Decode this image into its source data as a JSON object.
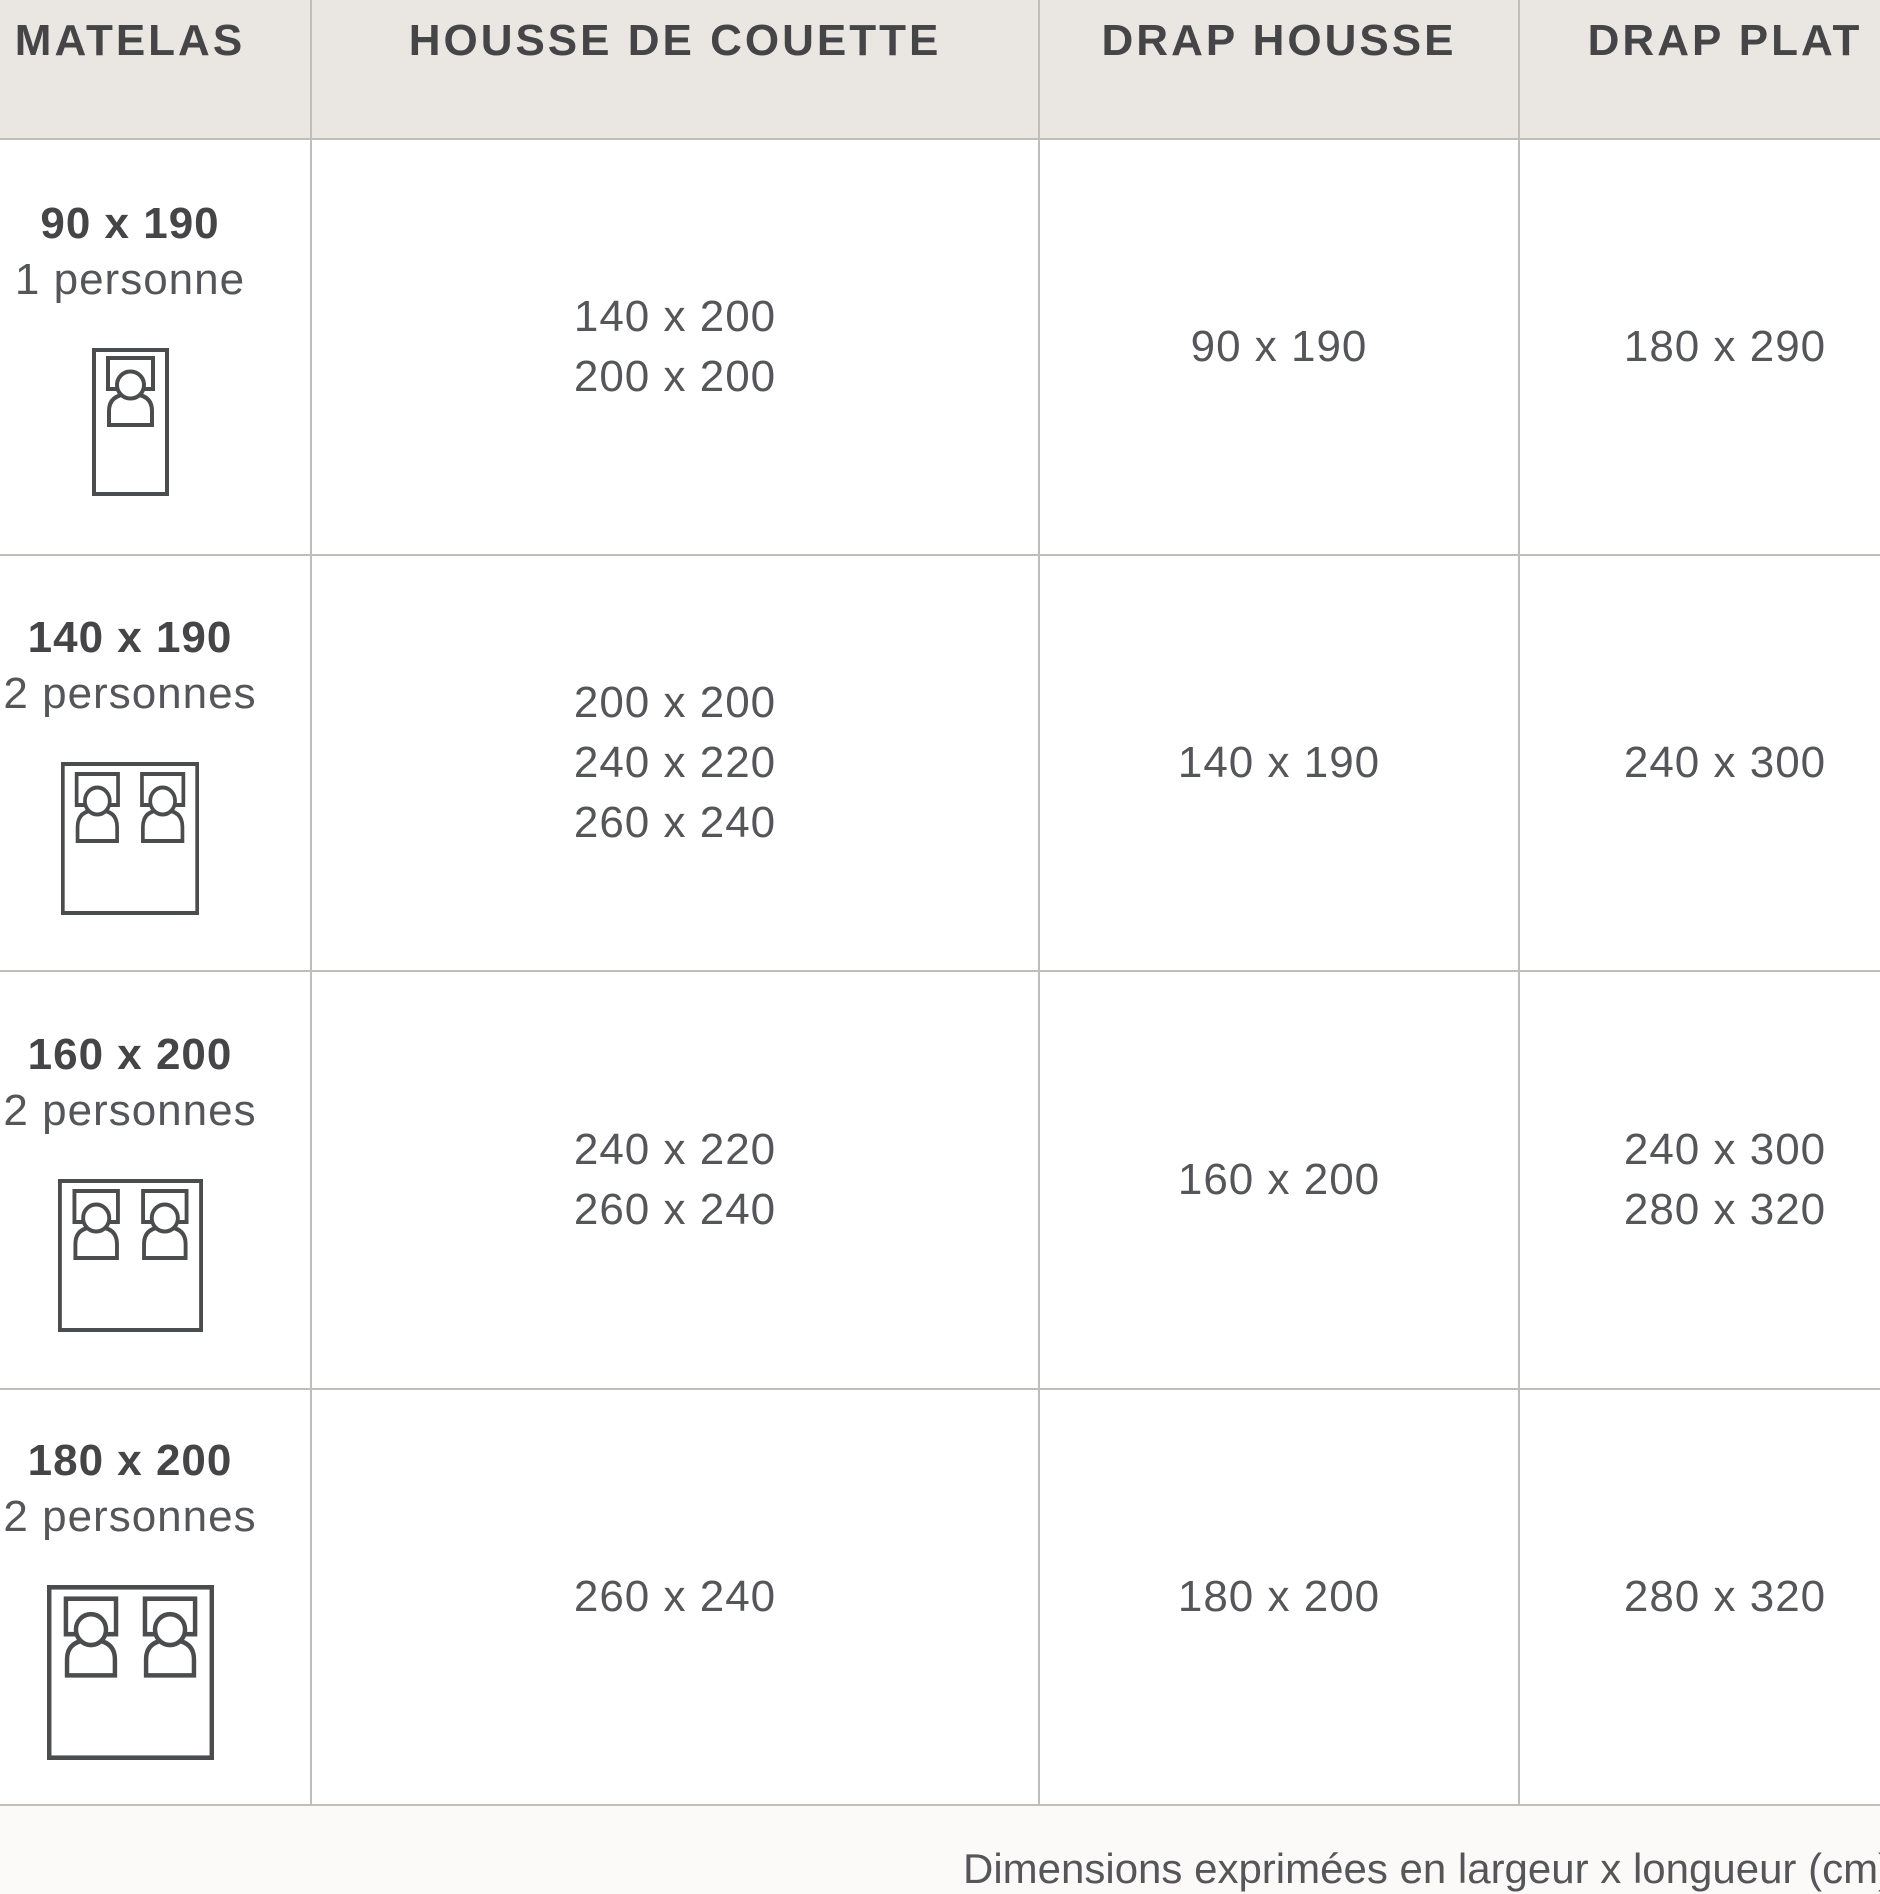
{
  "chart_data": {
    "type": "table",
    "columns": [
      "MATELAS",
      "HOUSSE DE COUETTE",
      "DRAP HOUSSE",
      "DRAP PLAT"
    ],
    "rows": [
      {
        "matelas_size": "90 x 190",
        "capacity": "1 personne",
        "bed_icon": "single-bed",
        "housse_de_couette": [
          "140 x 200",
          "200 x 200"
        ],
        "drap_housse": "90 x 190",
        "drap_plat": [
          "180 x 290"
        ]
      },
      {
        "matelas_size": "140 x 190",
        "capacity": "2 personnes",
        "bed_icon": "double-bed",
        "housse_de_couette": [
          "200 x 200",
          "240 x 220",
          "260 x 240"
        ],
        "drap_housse": "140 x 190",
        "drap_plat": [
          "240 x 300"
        ]
      },
      {
        "matelas_size": "160 x 200",
        "capacity": "2 personnes",
        "bed_icon": "double-bed",
        "housse_de_couette": [
          "240 x 220",
          "260 x 240"
        ],
        "drap_housse": "160 x 200",
        "drap_plat": [
          "240 x 300",
          "280 x 320"
        ]
      },
      {
        "matelas_size": "180 x 200",
        "capacity": "2 personnes",
        "bed_icon": "double-bed",
        "housse_de_couette": [
          "260 x 240"
        ],
        "drap_housse": "180 x 200",
        "drap_plat": [
          "280 x 320"
        ]
      }
    ],
    "footnote": "Dimensions exprimées en largeur x longueur (cm)"
  },
  "colors": {
    "page_bg": "#FBFAF8",
    "header_bg": "#EAE6E1",
    "cell_bg": "#FFFFFF",
    "border": "#C0BEBA",
    "text": "#55565A",
    "text_bold": "#454548",
    "icon_stroke": "#4B4C4E"
  }
}
